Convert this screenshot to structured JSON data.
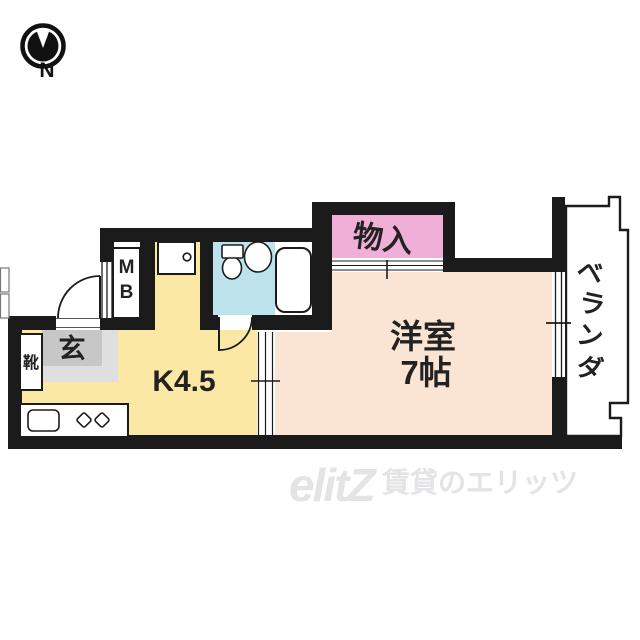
{
  "compass": {
    "label": "N"
  },
  "rooms": {
    "closet": {
      "label": "物入"
    },
    "western": {
      "line1": "洋室",
      "line2": "7帖"
    },
    "kitchen": {
      "label": "K4.5"
    },
    "entrance": {
      "label": "玄"
    },
    "shoe_box": {
      "label": "靴"
    },
    "meter_box": {
      "line1": "M",
      "line2": "B"
    },
    "veranda": {
      "chars": [
        "ベ",
        "ラ",
        "ン",
        "ダ"
      ]
    }
  },
  "watermark": {
    "logo": "elitZ",
    "text": "賃貸のエリッツ"
  },
  "colors": {
    "wall": "#1b1b1b",
    "kitchen": "#FBE8A5",
    "western_room": "#FAE4D3",
    "closet": "#F0AFD6",
    "bathroom": "#BCE2EC",
    "entrance_dark": "#C7C7C7",
    "entrance_light": "#DFDFDF",
    "label_text": "#222222",
    "watermark": "#E4E3E6"
  }
}
